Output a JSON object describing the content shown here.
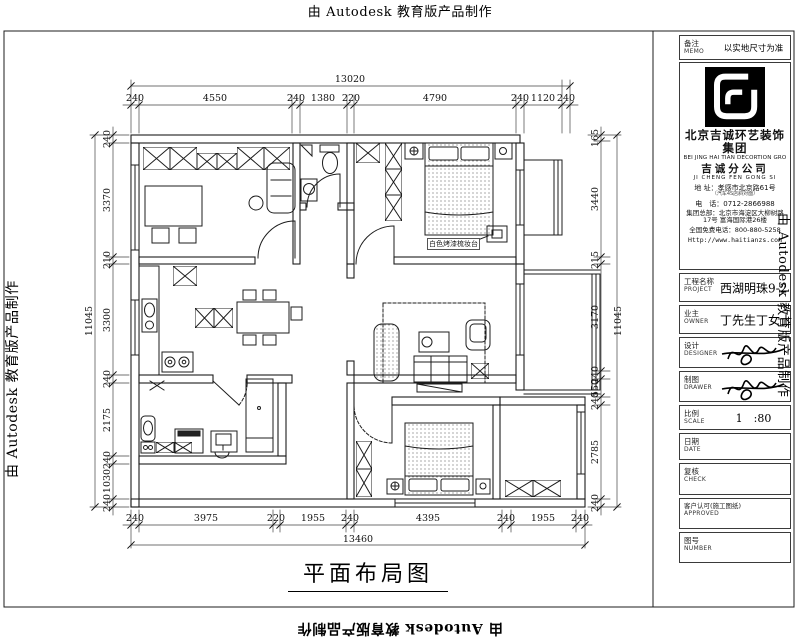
{
  "watermark": {
    "text": "由 Autodesk 教育版产品制作"
  },
  "sheet": {
    "drawing_title": "平面布局图"
  },
  "plan": {
    "annotation_vanity": "白色烤漆梳妆台",
    "dims": {
      "top_total": "13020",
      "top": [
        "240",
        "4550",
        "240",
        "1380",
        "220",
        "4790",
        "240",
        "1120",
        "240"
      ],
      "bottom_total": "13460",
      "bottom": [
        "240",
        "3975",
        "220",
        "1955",
        "240",
        "4395",
        "240",
        "1955",
        "240"
      ],
      "left_total": "11045",
      "left": [
        "240",
        "3370",
        "210",
        "3300",
        "240",
        "2175",
        "240",
        "1030",
        "240"
      ],
      "right_total": "11045",
      "right": [
        "165",
        "3440",
        "215",
        "3170",
        "240",
        "550",
        "240",
        "2785",
        "240"
      ]
    }
  },
  "title_block": {
    "memo": {
      "label_cn": "备注",
      "label_en": "MEMO",
      "value": "以实地尺寸为准"
    },
    "company": {
      "name_cn": "北京吉诚环艺装饰集团",
      "name_en": "BEI JING HAI TIAN DECORTION GRO",
      "branch_cn": "吉诚分公司",
      "branch_en": "JI CHENG FEN GONG SI",
      "address_label": "地 址：",
      "address_value": "孝感市北京路61号",
      "address_note": "（汽车4S店斜对面）",
      "phone_label": "电　话：",
      "phone_value": "0712-2866988",
      "hq_label": "集团总部：",
      "hq_line1": "北京市海淀区大柳树路",
      "hq_line2": "17号 富海国际港26楼",
      "hotline_label": "全国免费电话：",
      "hotline_value": "800-880-5258",
      "website": "Http://www.haitianzs.com"
    },
    "rows": [
      {
        "cn": "工程名称",
        "en": "PROJECT",
        "value": "西湖明珠9-2"
      },
      {
        "cn": "业主",
        "en": "OWNER",
        "value": "丁先生丁女士"
      },
      {
        "cn": "设计",
        "en": "DESIGNER",
        "value": ""
      },
      {
        "cn": "制图",
        "en": "DRAWER",
        "value": ""
      },
      {
        "cn": "比例",
        "en": "SCALE",
        "value": "1　:80"
      },
      {
        "cn": "日期",
        "en": "DATE",
        "value": ""
      },
      {
        "cn": "复核",
        "en": "CHECK",
        "value": ""
      },
      {
        "cn": "客户认可(施工图纸)",
        "en": "APPROVED",
        "value": ""
      },
      {
        "cn": "图号",
        "en": "NUMBER",
        "value": ""
      }
    ]
  }
}
